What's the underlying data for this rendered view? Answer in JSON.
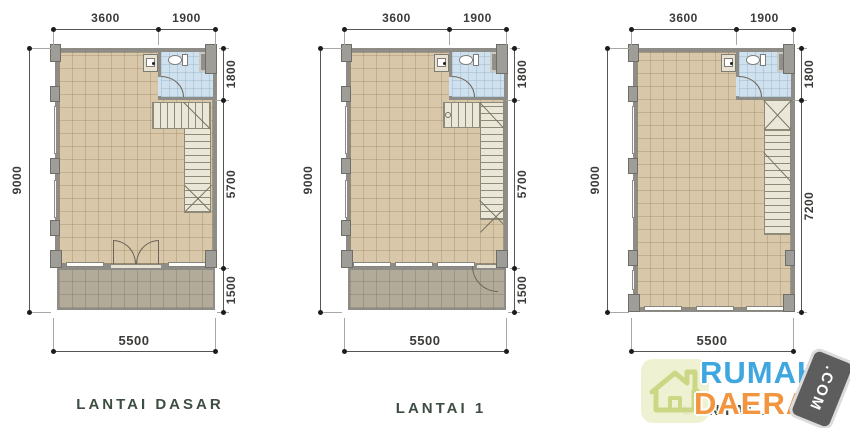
{
  "plans": [
    {
      "label": "LANTAI DASAR",
      "dims": {
        "top": [
          "3600",
          "1900"
        ],
        "left": "9000",
        "right": [
          "1800",
          "5700",
          "1500"
        ],
        "bottom": "5500"
      }
    },
    {
      "label": "LANTAI 1",
      "dims": {
        "top": [
          "3600",
          "1900"
        ],
        "left": "9000",
        "right": [
          "1800",
          "5700",
          "1500"
        ],
        "bottom": "5500"
      }
    },
    {
      "label": "LANTAI 2",
      "dims": {
        "top": [
          "3600",
          "1900"
        ],
        "left": "9000",
        "right": [
          "1800",
          "7200"
        ],
        "bottom": "5500"
      }
    }
  ],
  "watermark": {
    "word1": "RUMAH",
    "word2": "DAERAH",
    "badge": ".COM"
  },
  "colors": {
    "floor": "#d8c8a9",
    "terrace": "#b2ab9a",
    "bathroom": "#cfe1ee",
    "wall": "#8d8c86",
    "stair": "#ebe7d8",
    "dim_text": "#3b3b39",
    "label_text": "#3e4d41",
    "watermark_blue": "#3fa7e0",
    "watermark_orange": "#f2953e",
    "badge_bg": "#5d5d5d"
  }
}
